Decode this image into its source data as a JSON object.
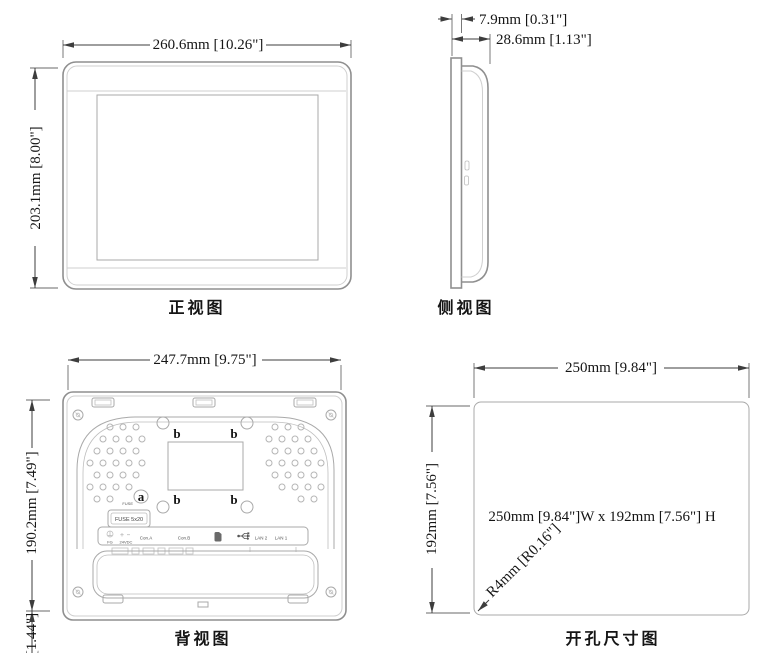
{
  "page": {
    "background": "#ffffff"
  },
  "front_view": {
    "caption": "正视图",
    "width_dim": "260.6mm [10.26\"]",
    "height_dim": "203.1mm [8.00\"]"
  },
  "side_view": {
    "caption": "侧视图",
    "bezel_depth_dim": "7.9mm [0.31\"]",
    "total_depth_dim": "28.6mm [1.13\"]"
  },
  "back_view": {
    "caption": "背视图",
    "width_dim": "247.7mm [9.75\"]",
    "height_dim": "190.2mm [7.49\"]",
    "bottom_dim": "[1.44\"]",
    "callout_a": "a",
    "callout_b": "b",
    "fuse_caption": "FUSE",
    "fuse_box_label": "FUSE 5x20",
    "ports": {
      "fg": "FG",
      "power": "24VDC",
      "con_a": "Con.A",
      "con_b": "Con.B",
      "lan2": "LAN 2",
      "lan1": "LAN 1"
    }
  },
  "cutout_view": {
    "caption": "开孔尺寸图",
    "width_dim": "250mm [9.84\"]",
    "height_dim": "192mm [7.56\"]",
    "center_label": "250mm [9.84\"]W x 192mm [7.56\"] H",
    "corner_radius_label": "R4mm [R0.16\"]"
  }
}
